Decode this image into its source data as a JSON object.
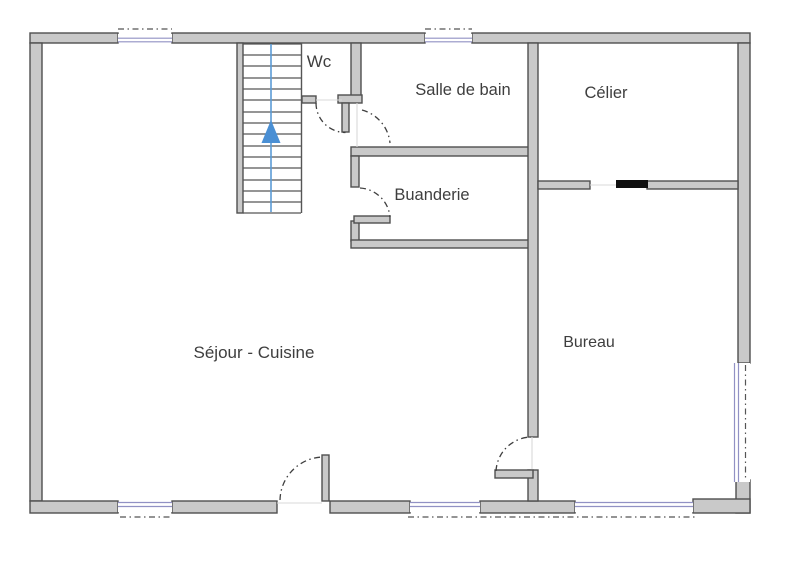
{
  "rooms": [
    {
      "id": "wc",
      "label": "Wc"
    },
    {
      "id": "salle-de-bain",
      "label": "Salle de bain"
    },
    {
      "id": "celier",
      "label": "Célier"
    },
    {
      "id": "buanderie",
      "label": "Buanderie"
    },
    {
      "id": "bureau",
      "label": "Bureau"
    },
    {
      "id": "sejour-cuisine",
      "label": "Séjour - Cuisine"
    }
  ],
  "stairs": {
    "direction": "up"
  },
  "colors": {
    "wall_fill": "#c9c9c9",
    "wall_stroke": "#4f4f4f",
    "window_frame": "#9191c4",
    "stair_center_line": "#5b9bd5",
    "stair_arrow": "#4a8fd4",
    "sliding_door_black": "#0f0f0f",
    "text": "#3e3e3e",
    "background": "#ffffff"
  }
}
